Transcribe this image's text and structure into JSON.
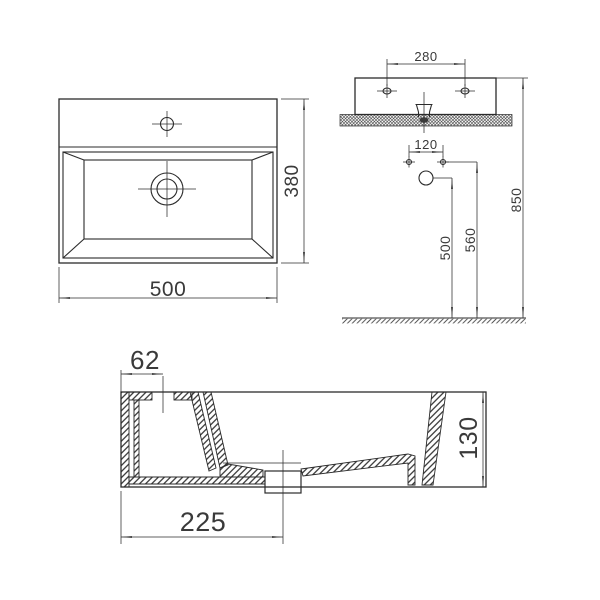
{
  "colors": {
    "background": "#ffffff",
    "line": "#2b2b2b",
    "text": "#3a3a3a"
  },
  "top_view": {
    "width": "500",
    "depth": "380"
  },
  "front_view": {
    "fixing_hole_spacing": "280",
    "outlet_spacing": "120",
    "rim_height": "850",
    "fixing_height": "560",
    "outlet_height": "500"
  },
  "section_view": {
    "tap_hole_offset": "62",
    "drain_offset": "225",
    "height": "130"
  }
}
